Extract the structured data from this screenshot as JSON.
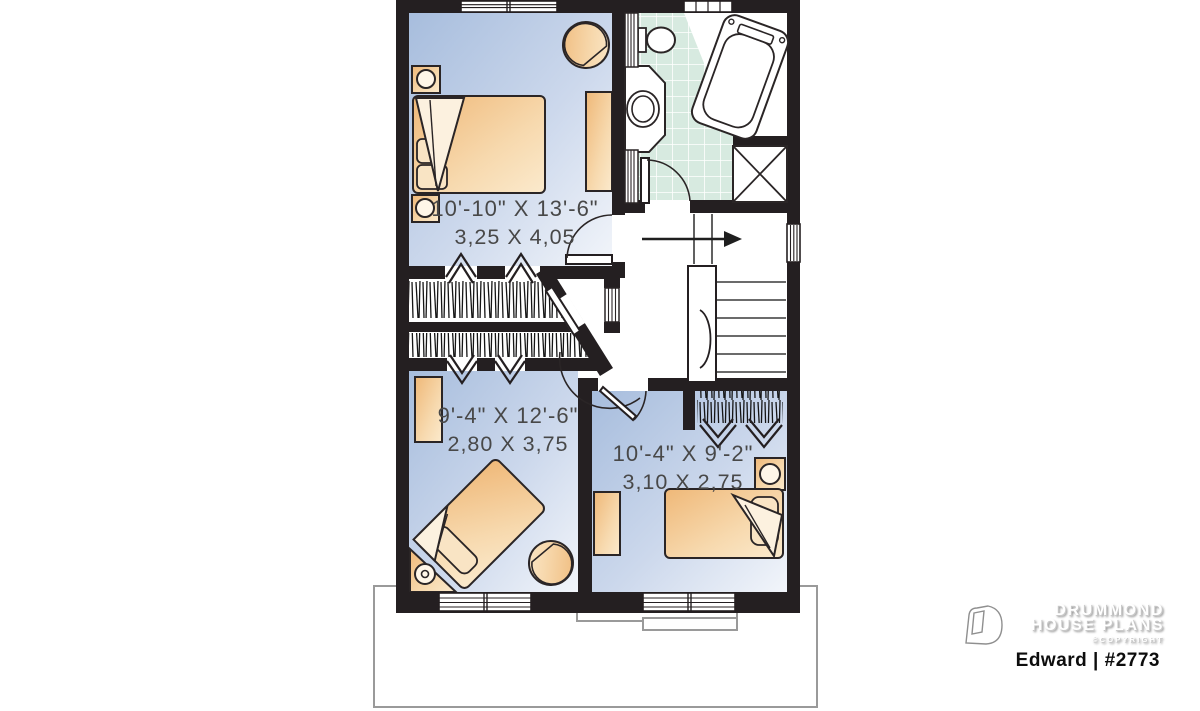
{
  "plan": {
    "rooms": [
      {
        "name": "bedroom-1",
        "imperial": "10'-10\" X 13'-6\"",
        "metric": "3,25 X 4,05"
      },
      {
        "name": "bedroom-2",
        "imperial": "9'-4\" X 12'-6\"",
        "metric": "2,80 X 3,75"
      },
      {
        "name": "bedroom-3",
        "imperial": "10'-4\" X 9'-2\"",
        "metric": "3,10 X 2,75"
      }
    ]
  },
  "branding": {
    "name_line1": "DRUMMOND",
    "name_line2": "HOUSE PLANS",
    "copyright": "©COPYRIGHT",
    "plan_label": "Edward | #2773",
    "logo_icon": "drummond-d-icon"
  },
  "colors": {
    "wall": "#241f21",
    "floor_blue": "#aebfde",
    "furniture_tan": "#f2bc82",
    "tile_mint": "#d7eae0"
  }
}
